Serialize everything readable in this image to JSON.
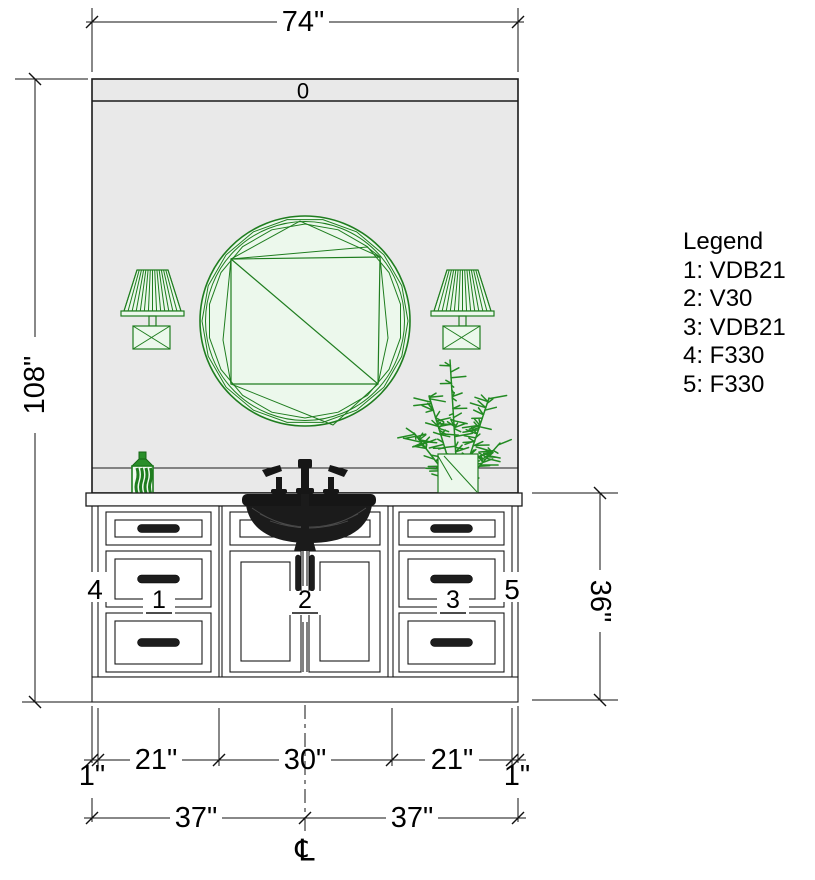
{
  "drawing": {
    "wall_label": "0",
    "centerline_symbol": "℄",
    "dims": {
      "overall_width": "74\"",
      "ceiling_height": "108\"",
      "vanity_height": "36\"",
      "filler_left": "1\"",
      "cab_left": "21\"",
      "cab_center": "30\"",
      "cab_right": "21\"",
      "filler_right": "1\"",
      "half_left": "37\"",
      "half_right": "37\""
    },
    "unit_labels": {
      "left_drawer_bank": "1",
      "center_doors": "2",
      "right_drawer_bank": "3",
      "left_filler": "4",
      "right_filler": "5"
    }
  },
  "legend": {
    "title": "Legend",
    "items": [
      "1: VDB21",
      "2: V30",
      "3: VDB21",
      "4: F330",
      "5: F330"
    ]
  },
  "colors": {
    "accent_green": "#1f7d1f",
    "light_green_fill": "#ecf8ec",
    "wall_gray": "#e9e9e9",
    "line_black": "#1a1a1a",
    "fixture_black": "#161616"
  }
}
